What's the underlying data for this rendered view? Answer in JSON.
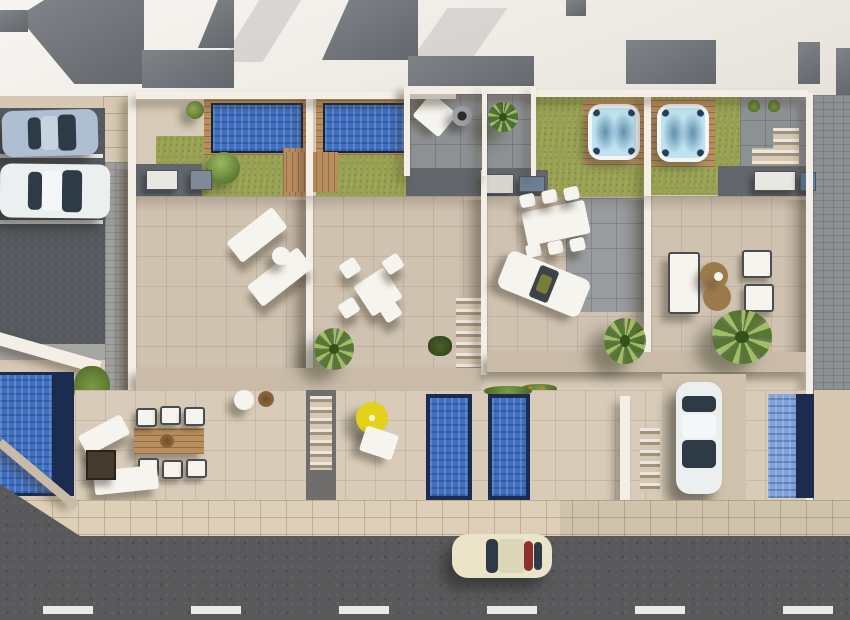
{
  "meta": {
    "description": "Top-down 3D architectural visualization of a row of four townhouses with rooftop pool solariums, tiled terraces, lower patios with plunge pools, a side parking lot and a street with traffic",
    "view": "aerial plan view",
    "visible_text": "none"
  },
  "palette": {
    "roof_white": "#f0ece4",
    "roof_dark": "#71757a",
    "terrace_tile": "#cfc2b1",
    "terrace_tile_light": "#d8cbb9",
    "rooftop_gray": "#8e9194",
    "gray_sub": "#9a9da0",
    "bbq_strip": "#62666b",
    "lawn": "#97a050",
    "wood_deck": "#b98e5f",
    "pool_water": "#3f6fc0",
    "pool_water_light": "#7fa4dc",
    "pool_border": "#1c2c50",
    "hot_tub_rim": "#f2f5f6",
    "parking_asphalt": "#56595e",
    "paver_gray": "#9fa09d",
    "paver_light": "#a6a6a3",
    "walkway_beige": "#d6c8b2",
    "sidewalk": "#ddcfb8",
    "road": "#59595b",
    "road_dash": "#eceae4",
    "wall_white": "#f3efe7",
    "wall_beige": "#c9bba8",
    "car_silver": "#aebfd2",
    "car_white": "#eceff0",
    "car_cream": "#ece4c9",
    "car_glass": "#2e3a46",
    "stripe_red": "#8d2f2f",
    "furniture_white": "#f6f4ef",
    "chair_dark": "#4a4d50",
    "coffee_table_brown": "#9b7a4b",
    "umbrella_yellow": "#e3d218",
    "bin_blue": "#5a7da8",
    "driveway": "#cfc2ac",
    "green_cushion": "#7a7d3a"
  },
  "scene": {
    "units": 4,
    "rooftop_level": {
      "rooftop_pools": 2,
      "pool_decks": "wooden frames with step decks",
      "hot_tubs": 2,
      "hot_tub_decks": "square wooden platforms on lawn",
      "roof_terraces": [
        "daybed and fire bowl terrace",
        "palm terrace",
        "upper terrace with bbq"
      ],
      "bbq_stations": 5,
      "trash_bin": 1
    },
    "terrace_level": {
      "unit1": [
        "2 sun loungers",
        "round side table",
        "lawn tree"
      ],
      "unit2": [
        "square dining table with 4 chairs",
        "palm tree"
      ],
      "unit3": [
        "white dining table with 6 chairs",
        "double daybed with green cushion",
        "palm tree",
        "staircase"
      ],
      "unit4": [
        "garden sofa",
        "2 armchairs",
        "double round brown coffee table",
        "large palm tree"
      ]
    },
    "lower_level": {
      "plunge_pools": 4,
      "unit1_patio": [
        "wooden dining table with 6 chairs",
        "2 loungers",
        "fire pit table"
      ],
      "unit2_patio": [
        "yellow parasol",
        "white bistro chair"
      ],
      "unit3_patio": [
        "stairs",
        "driveway with parked white car"
      ],
      "unit4_patio": [
        "plunge pool"
      ]
    },
    "street_side": {
      "parking_cars": [
        "silver coupe",
        "white hatchback"
      ],
      "parking_lines": 2,
      "left_pool": "blue pool at plot edge",
      "sidewalk": "beige tiled",
      "road": "asphalt with dashed white center line",
      "moving_car": "cream classic sports car"
    }
  }
}
